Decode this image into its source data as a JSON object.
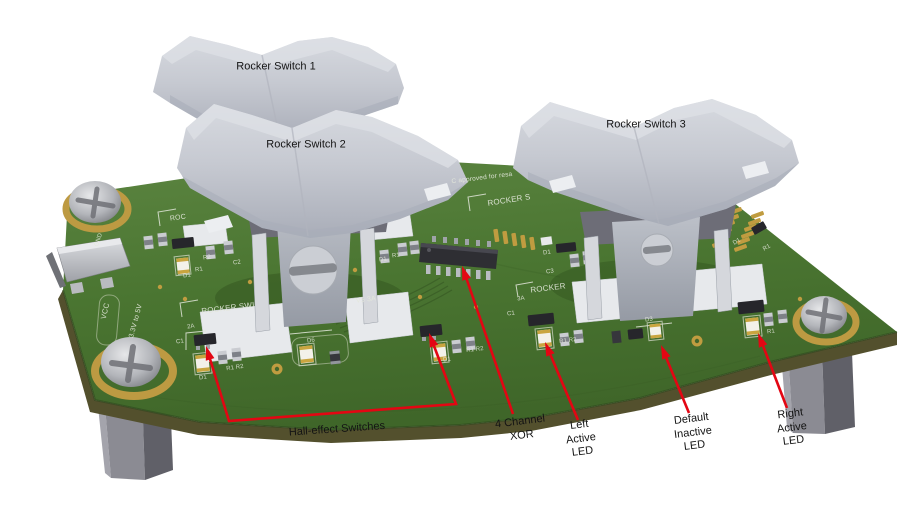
{
  "figure": {
    "description": "3D render of a rocker-switch evaluation PCB with red callout annotations"
  },
  "colors": {
    "annotation_red": "#e30613",
    "board_green": "#4a7531",
    "board_edge": "#53502d",
    "gold": "#bd9a42",
    "rocker_gray": "#c6c9d1"
  },
  "switches": [
    {
      "label": "Rocker Switch 1"
    },
    {
      "label": "Rocker Switch 2"
    },
    {
      "label": "Rocker Switch 3"
    }
  ],
  "annotations": {
    "hall": {
      "label": "Hall-effect Switches"
    },
    "xor": {
      "lines": [
        "4 Channel",
        "XOR"
      ]
    },
    "left_led": {
      "lines": [
        "Left",
        "Active",
        "LED"
      ]
    },
    "default_led": {
      "lines": [
        "Default",
        "Inactive",
        "LED"
      ]
    },
    "right_led": {
      "lines": [
        "Right",
        "Active",
        "LED"
      ]
    }
  },
  "silkscreen": {
    "rocker_frag_1": "ROC",
    "rocker_frag_2": "ROCKER SWI",
    "rocker_frag_3": "ROCKER S",
    "rocker_frag_4": "ROCKER",
    "approved": "C approved for resa",
    "power_rating": "V5 3A",
    "vcc": "VCC",
    "gnd": "GND",
    "voltage_range": "3.3V to 5V",
    "refs": {
      "d1": "D1",
      "r1": "R1",
      "r2": "R2",
      "r1r2": "R1 R2",
      "c1": "C1",
      "c2": "C2",
      "c3": "C3",
      "d3": "D3",
      "d6": "D6",
      "a2": "2A",
      "a3": "3A"
    }
  }
}
